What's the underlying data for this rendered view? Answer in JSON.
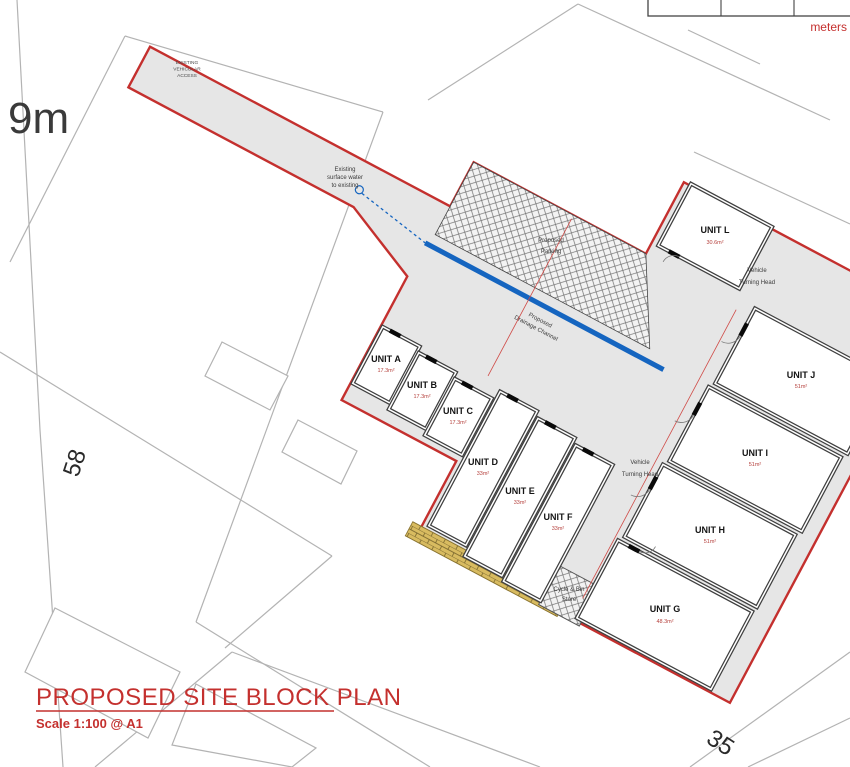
{
  "meta": {
    "plan_title": "PROPOSED SITE BLOCK PLAN",
    "scale_note": "Scale 1:100 @ A1"
  },
  "scale_bar": {
    "label": "meters"
  },
  "context": {
    "road_width": "9m",
    "house_left": "58",
    "house_bottom": "35"
  },
  "annotations": {
    "access": [
      "EXISTING",
      "VEHICULAR",
      "ACCESS"
    ],
    "surface_water": [
      "Existing",
      "surface water",
      "to existing"
    ],
    "drainage": [
      "Proposed",
      "Drainage Channel"
    ],
    "parking": [
      "Proposed",
      "Parking"
    ],
    "turning_head_upper": [
      "Vehicle",
      "Turning Head"
    ],
    "turning_head_central": [
      "Vehicle",
      "Turning Head"
    ],
    "bin_store": [
      "Cycle & Bin",
      "Store"
    ]
  },
  "units": [
    {
      "name": "UNIT A",
      "area": "17.3m²"
    },
    {
      "name": "UNIT B",
      "area": "17.3m²"
    },
    {
      "name": "UNIT C",
      "area": "17.3m²"
    },
    {
      "name": "UNIT D",
      "area": "33m²"
    },
    {
      "name": "UNIT E",
      "area": "33m²"
    },
    {
      "name": "UNIT F",
      "area": "33m²"
    },
    {
      "name": "UNIT G",
      "area": "48.3m²"
    },
    {
      "name": "UNIT H",
      "area": "51m²"
    },
    {
      "name": "UNIT I",
      "area": "51m²"
    },
    {
      "name": "UNIT J",
      "area": "51m²"
    },
    {
      "name": "UNIT L",
      "area": "30.6m²"
    }
  ],
  "colors": {
    "boundary_red": "#c4302e",
    "drainage_blue": "#1565c0",
    "site_grey": "#e6e6e6",
    "brick_yellow": "#d8bb60"
  }
}
